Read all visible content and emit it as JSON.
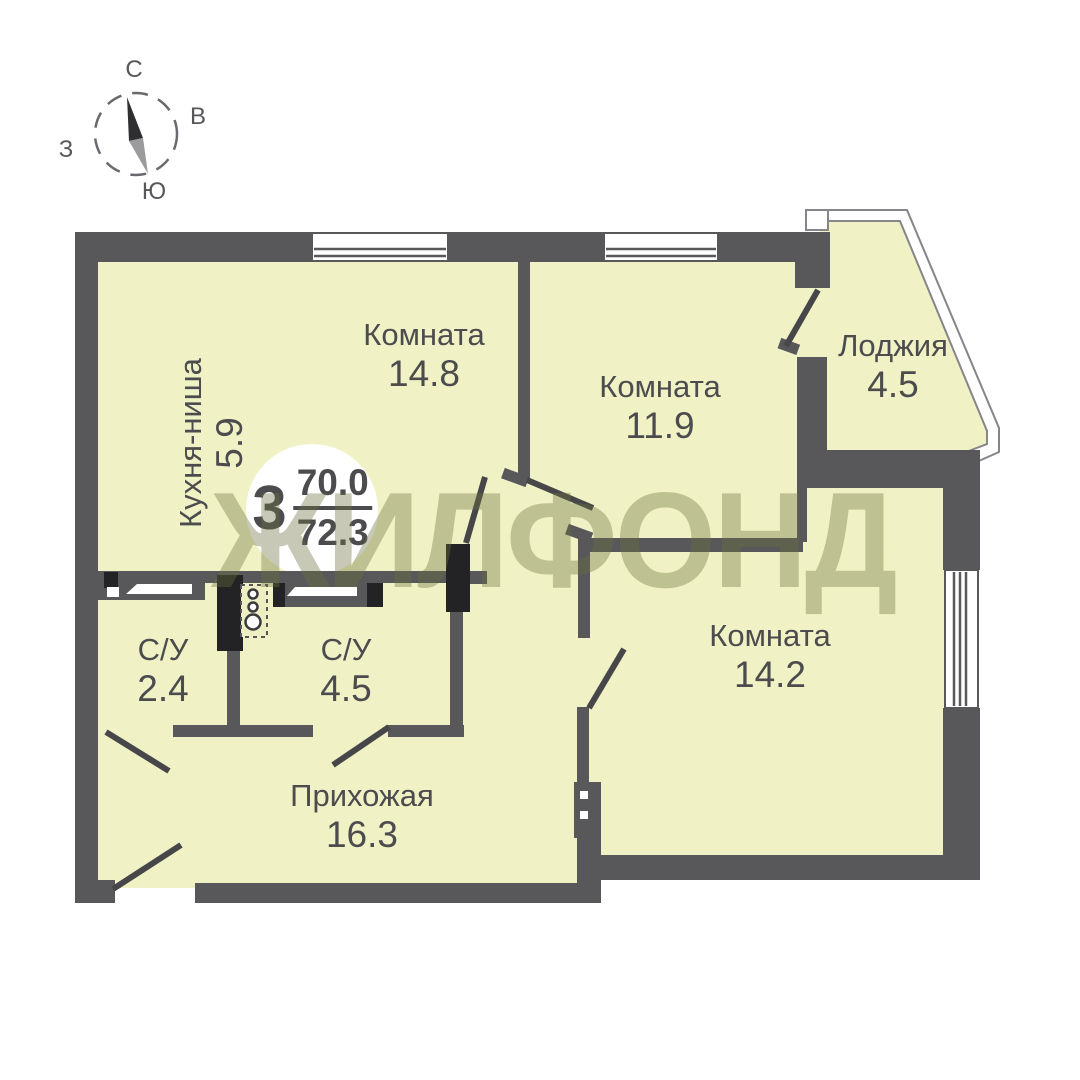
{
  "compass": {
    "n": "С",
    "e": "В",
    "w": "З",
    "s": "Ю"
  },
  "badge": {
    "rooms": "3",
    "area_top": "70.0",
    "area_bottom": "72.3"
  },
  "watermark": "ЖИЛФОНД",
  "rooms": [
    {
      "name": "Кухня-ниша",
      "area": "5.9"
    },
    {
      "name": "Комната",
      "area": "14.8"
    },
    {
      "name": "Комната",
      "area": "11.9"
    },
    {
      "name": "Лоджия",
      "area": "4.5"
    },
    {
      "name": "Комната",
      "area": "14.2"
    },
    {
      "name": "С/У",
      "area": "2.4"
    },
    {
      "name": "С/У",
      "area": "4.5"
    },
    {
      "name": "Прихожая",
      "area": "16.3"
    }
  ],
  "colors": {
    "wall": "#58585a",
    "room": "#f0f2c5",
    "fixture": "#232325",
    "text": "#4c4c4e",
    "watermark": "#6d7040",
    "white": "#ffffff"
  }
}
